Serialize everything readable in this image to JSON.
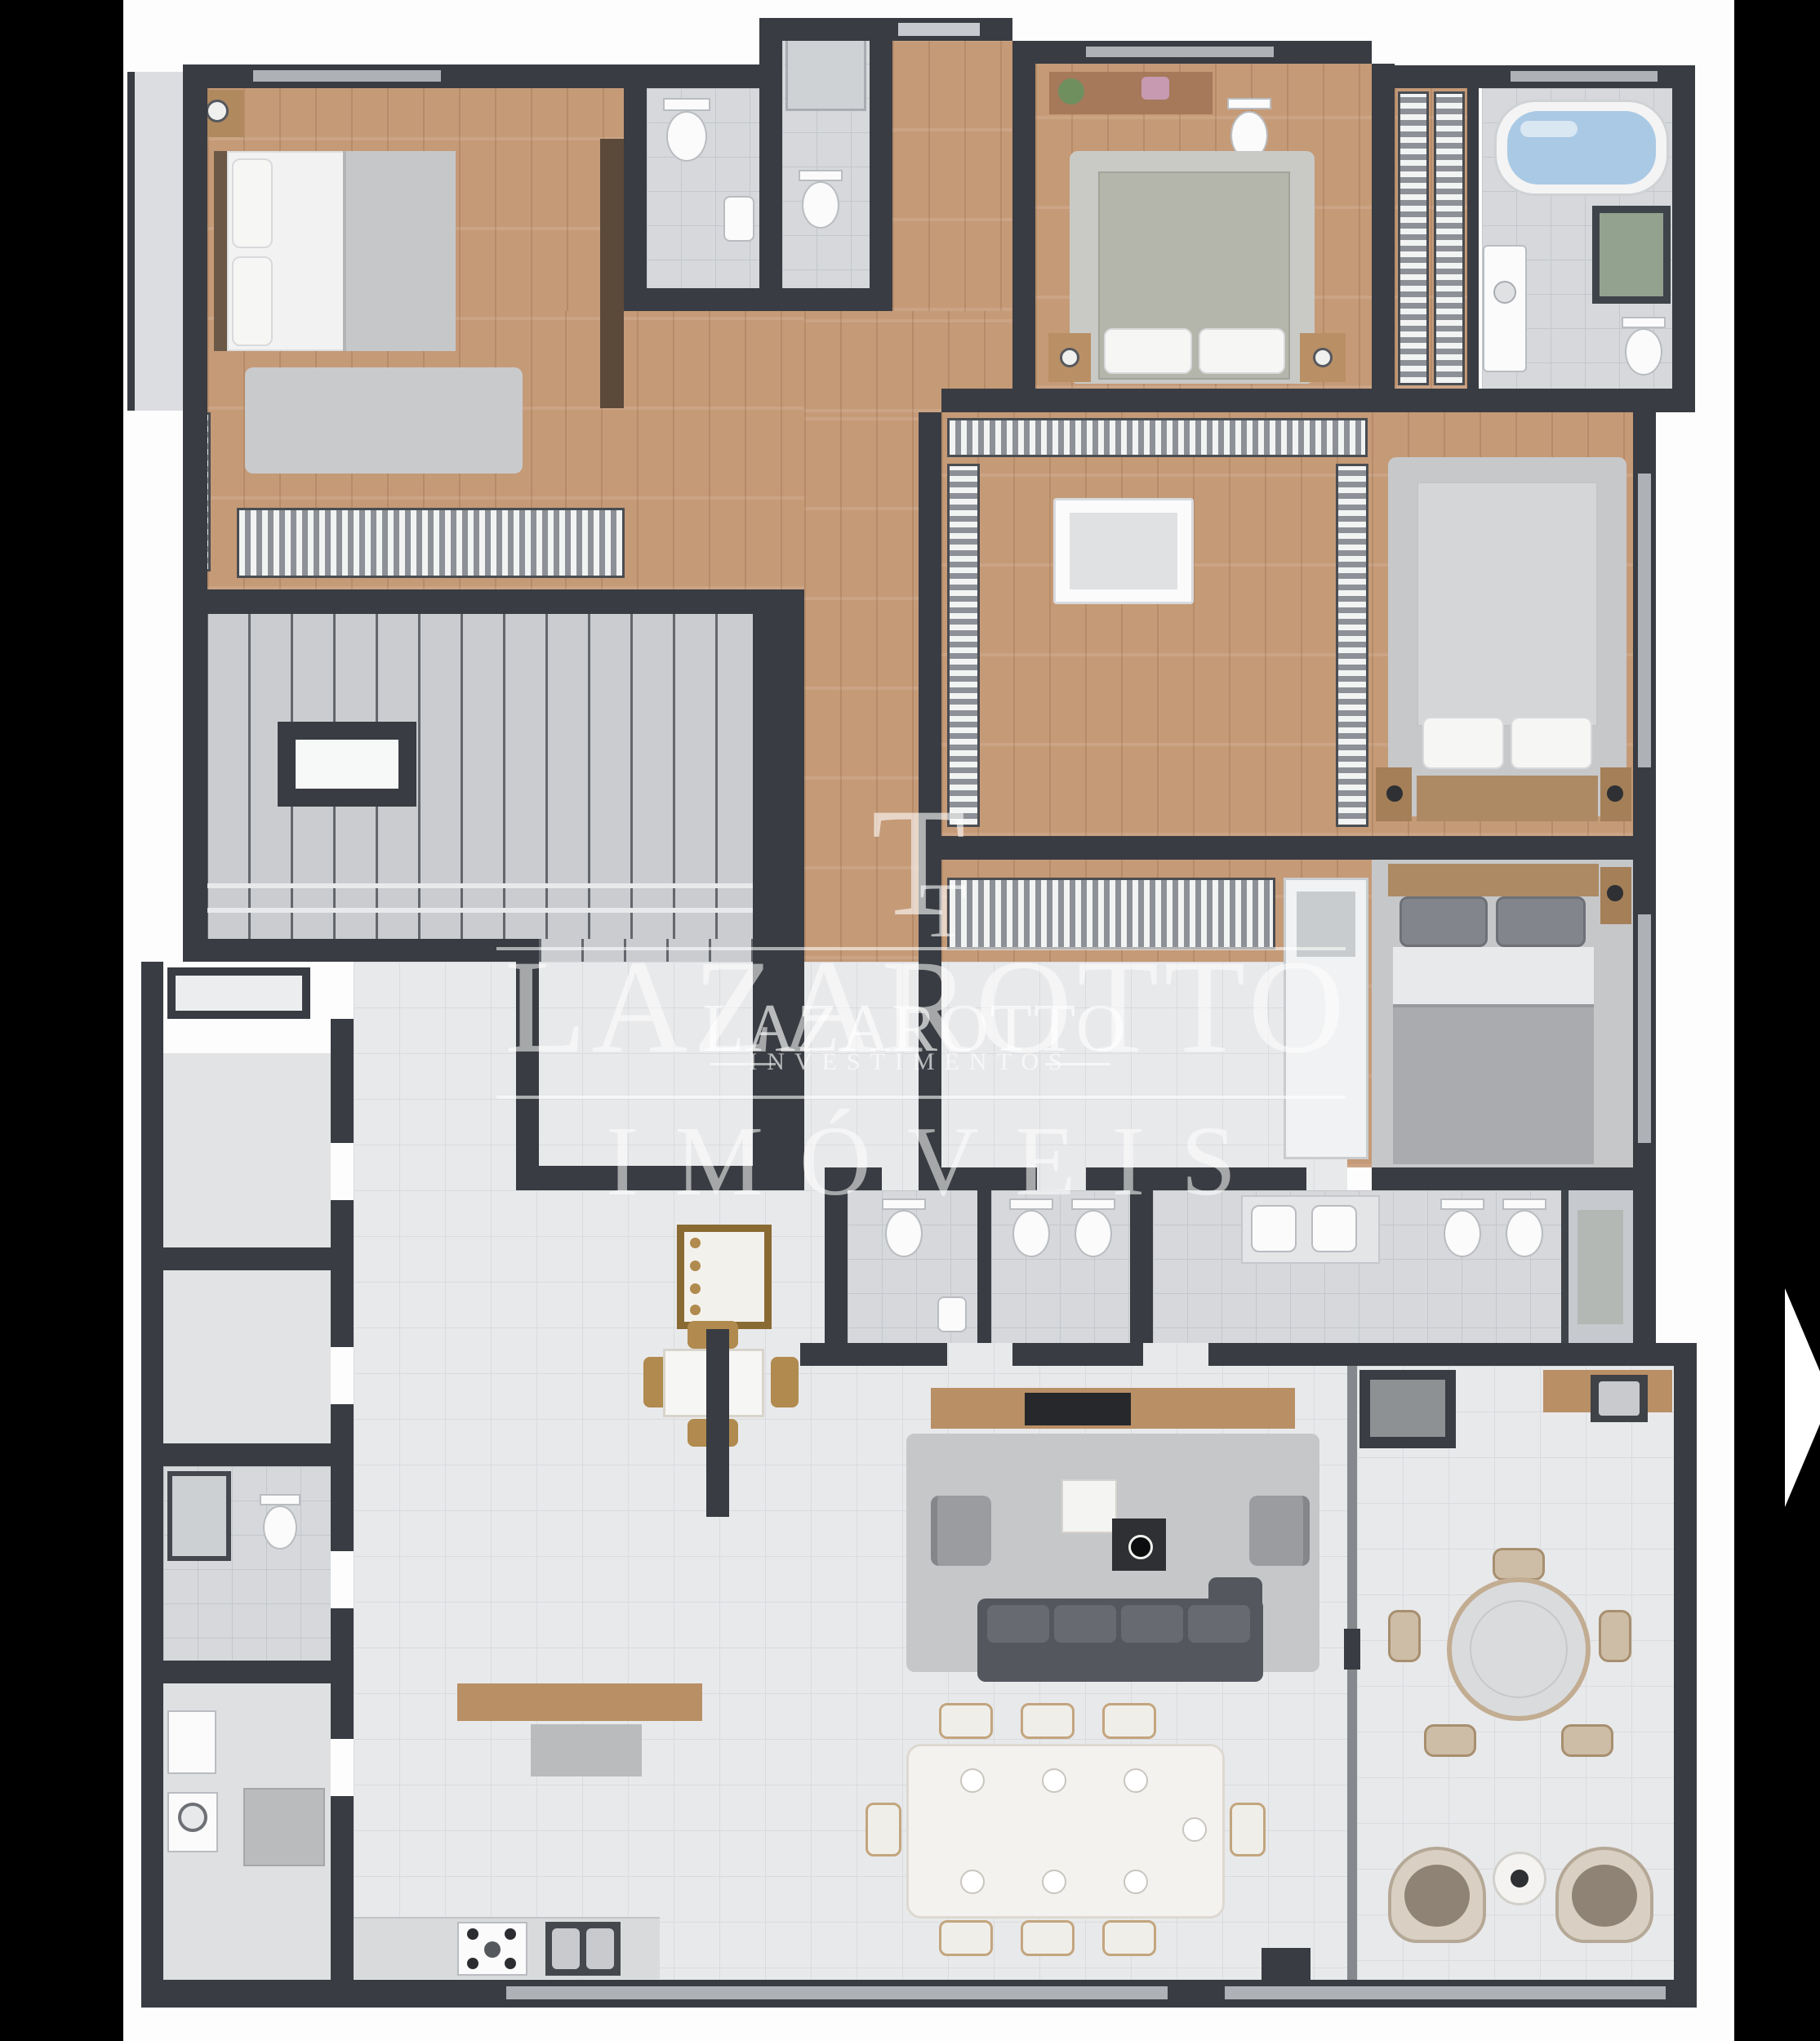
{
  "watermarks": {
    "primary": {
      "brand": "LAZAROTTO",
      "division": "IMÓVEIS"
    },
    "logo": {
      "monogram": "T",
      "brand": "LAZAROTTO",
      "division": "INVESTIMENTOS"
    }
  },
  "carousel": {
    "next_icon": "chevron-right-icon"
  },
  "palette": {
    "frame_bar": "#000000",
    "wall": "#393c42",
    "wood_floor": "#c59a77",
    "tile_light": "#e8e9eb",
    "tile_gray": "#d6d8db",
    "bathtub_water": "#aac9e4",
    "sofa": "#54575d",
    "accent_gold": "#b08a4e",
    "watermark": "#ffffff"
  }
}
